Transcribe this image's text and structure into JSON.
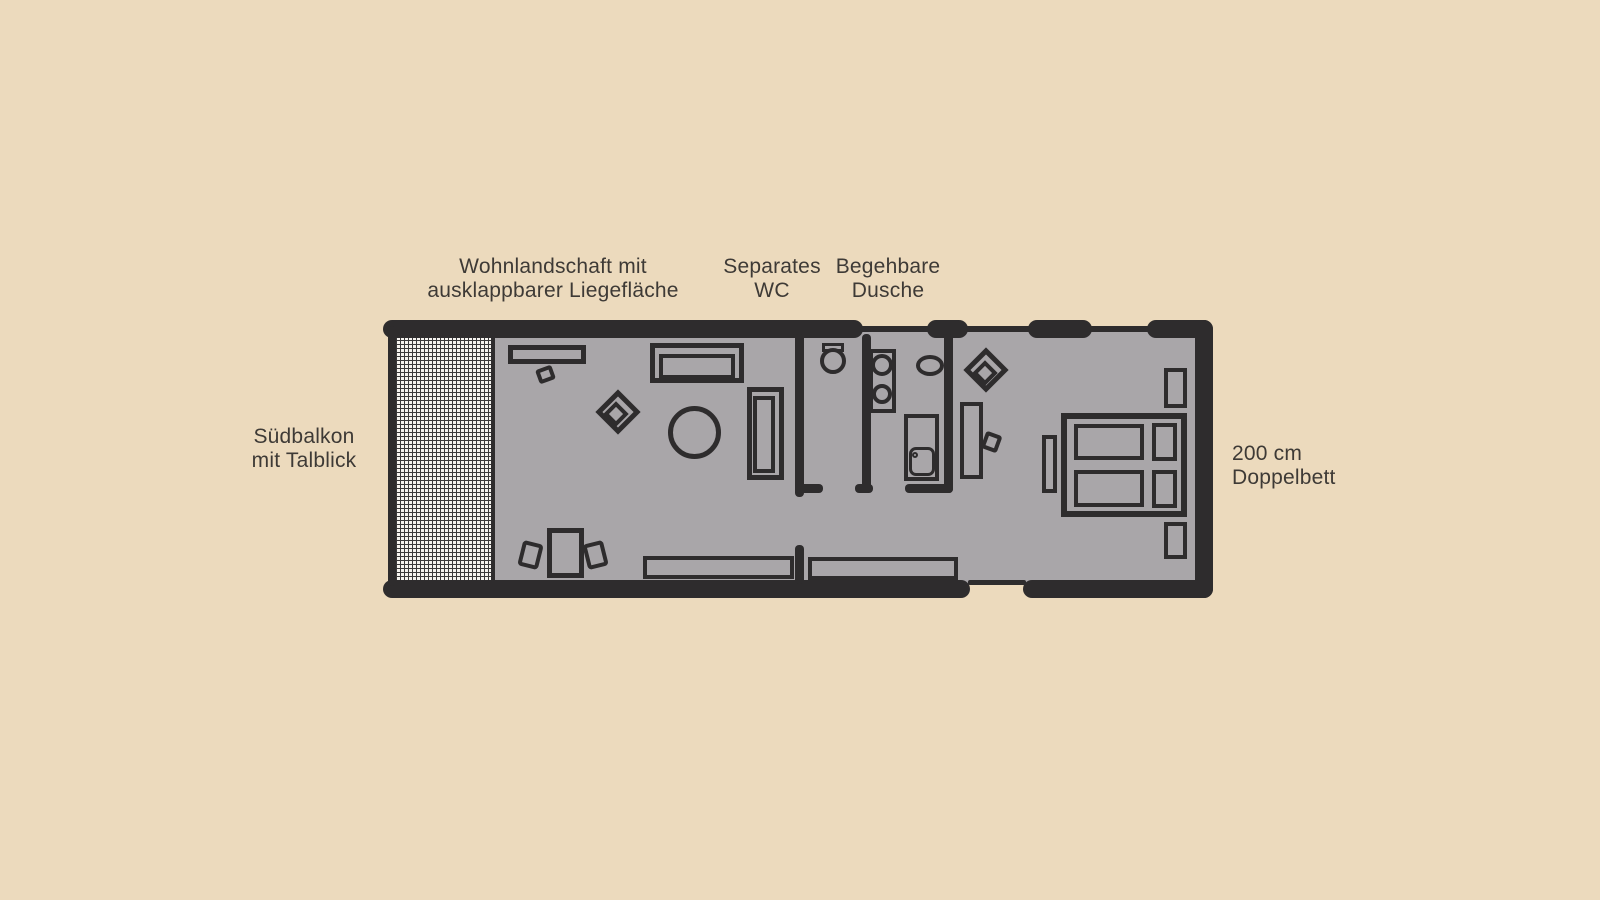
{
  "labels": {
    "living": {
      "line1": "Wohnlandschaft mit",
      "line2": "ausklappbarer Liegefläche"
    },
    "wc": {
      "line1": "Separates",
      "line2": "WC"
    },
    "shower": {
      "line1": "Begehbare",
      "line2": "Dusche"
    },
    "balcony": {
      "line1": "Südbalkon",
      "line2": "mit Talblick"
    },
    "bed": {
      "line1": "200 cm",
      "line2": "Doppelbett"
    },
    "area": "56 m²"
  },
  "colors": {
    "bg": "#ecdabd",
    "wall": "#2e2c2d",
    "floor": "#a9a6a9",
    "hatch": "#f6f4f0",
    "text": "#3e3a36"
  }
}
